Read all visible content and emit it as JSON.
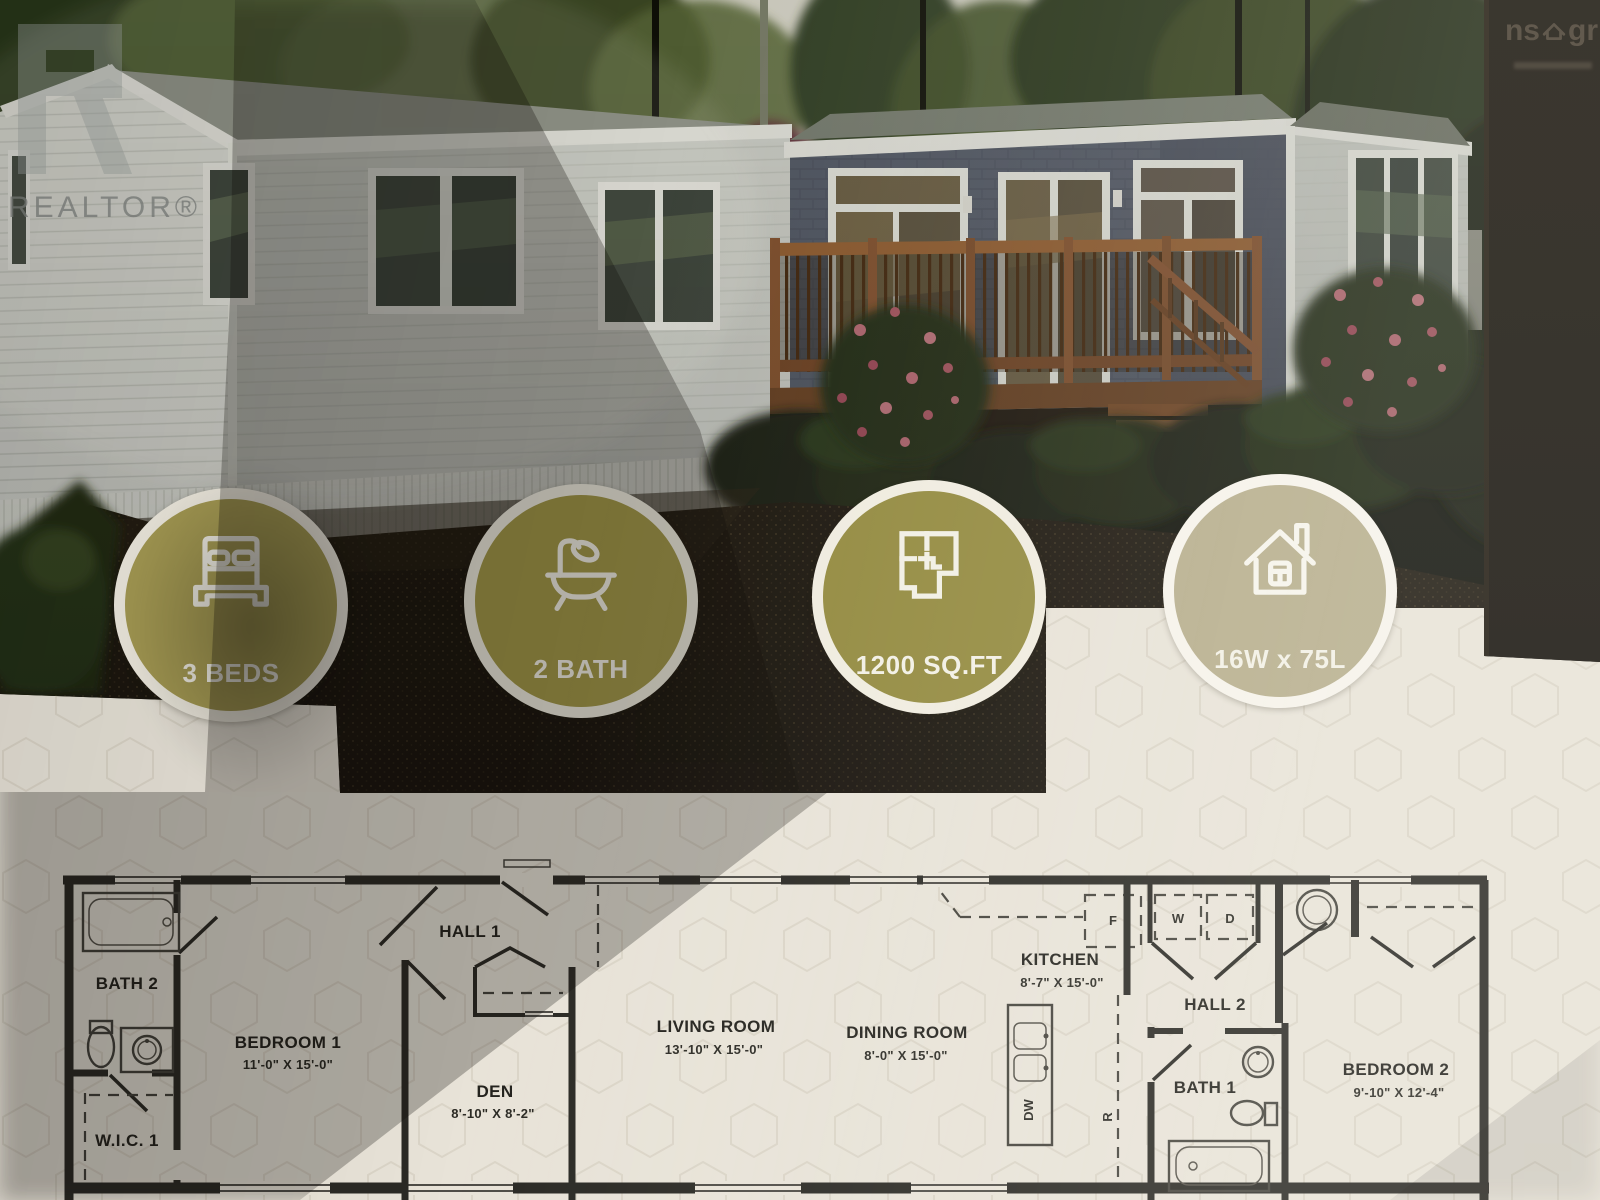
{
  "watermarks": {
    "realtor": "REALTOR®",
    "corner_left": "ns",
    "corner_right": "gr"
  },
  "badges": [
    {
      "icon": "bed-icon",
      "label": "3 BEDS"
    },
    {
      "icon": "bathtub-icon",
      "label": "2 BATH"
    },
    {
      "icon": "floorplan-icon",
      "label": "1200 SQ.FT"
    },
    {
      "icon": "house-icon",
      "label": "16W x 75L"
    }
  ],
  "floorplan": {
    "rooms": [
      {
        "name": "BATH 2",
        "dims": ""
      },
      {
        "name": "BEDROOM 1",
        "dims": "11'-0\" X 15'-0\""
      },
      {
        "name": "HALL 1",
        "dims": ""
      },
      {
        "name": "DEN",
        "dims": "8'-10\" X 8'-2\""
      },
      {
        "name": "LIVING ROOM",
        "dims": "13'-10\" X 15'-0\""
      },
      {
        "name": "DINING ROOM",
        "dims": "8'-0\" X 15'-0\""
      },
      {
        "name": "KITCHEN",
        "dims": "8'-7\" X 15'-0\""
      },
      {
        "name": "HALL 2",
        "dims": ""
      },
      {
        "name": "BATH 1",
        "dims": ""
      },
      {
        "name": "BEDROOM 2",
        "dims": "9'-10\" X 12'-4\""
      },
      {
        "name": "W.I.C. 1",
        "dims": ""
      }
    ],
    "appliances": {
      "washer": "W",
      "dryer": "D",
      "fridge": "F",
      "dishwasher": "DW",
      "range": "R"
    }
  },
  "colors": {
    "badge_gold": "#a29849",
    "badge_gold_light": "#b7ae8d",
    "flyer_cream": "#e8e3d8",
    "plan_ink": "#2b2a25"
  }
}
